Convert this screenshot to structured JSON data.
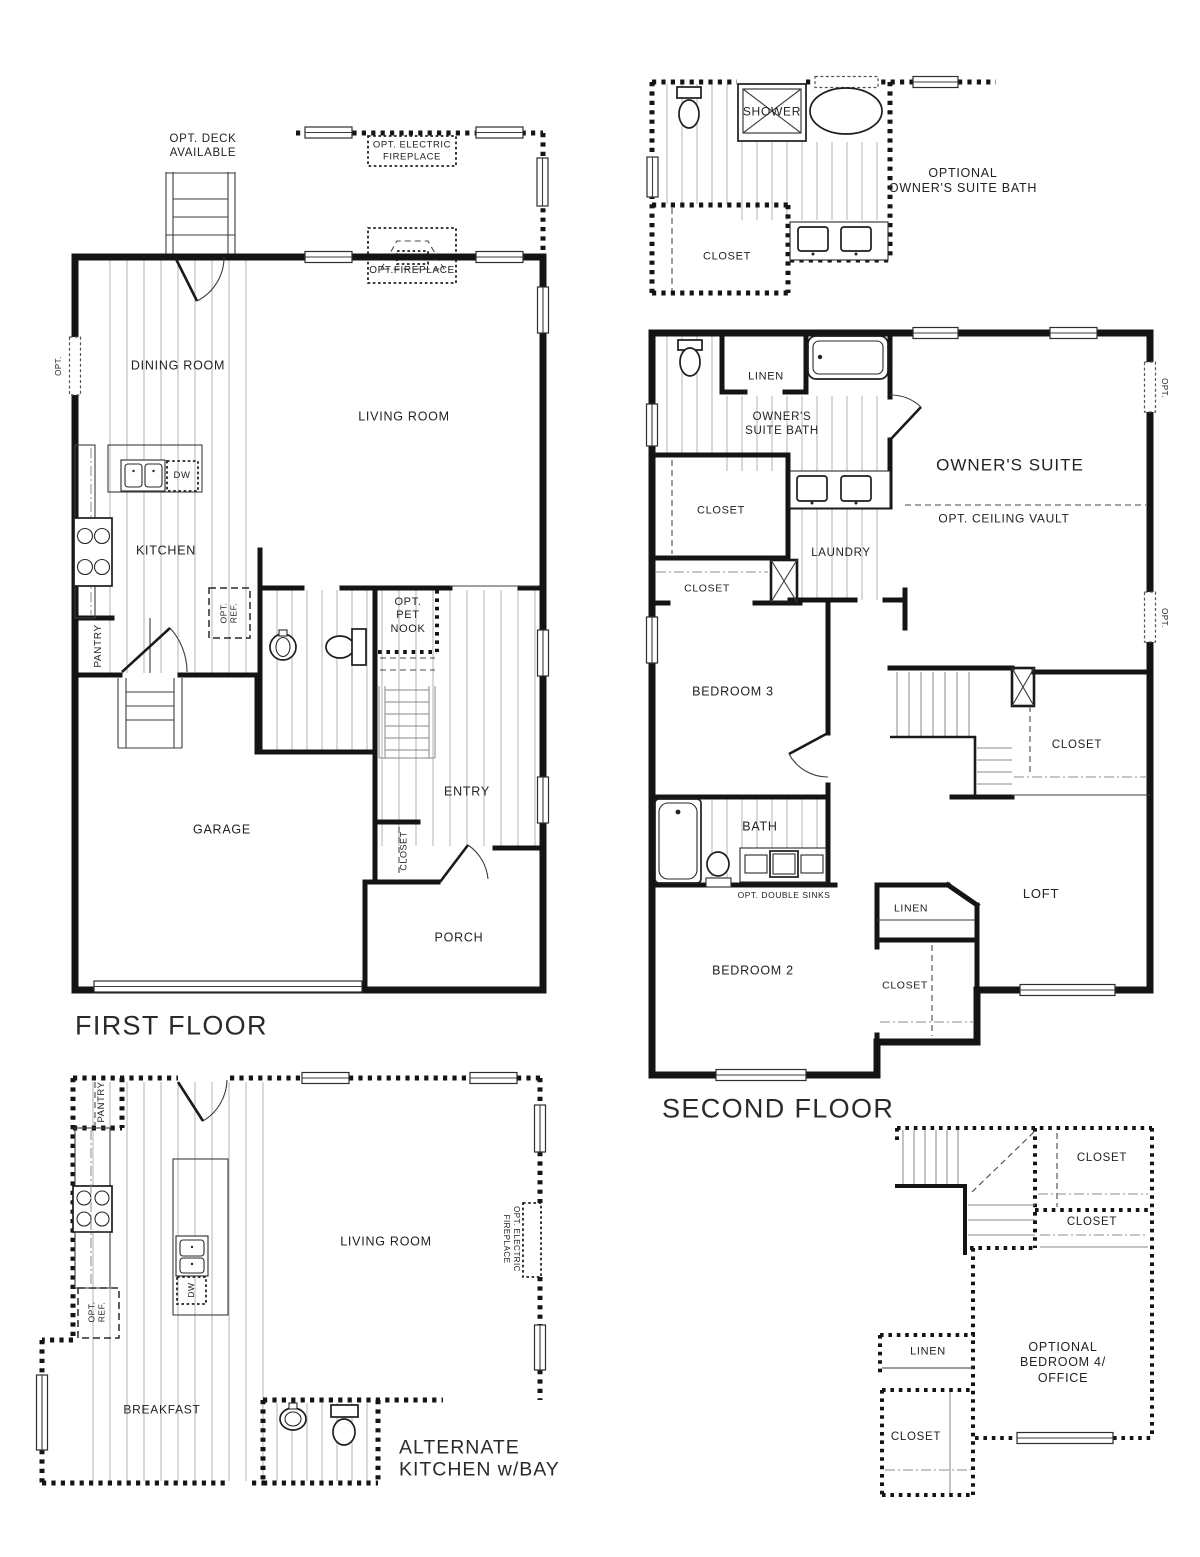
{
  "sheet": {
    "background": "#ffffff",
    "ink": "#141414"
  },
  "first_floor": {
    "title": "FIRST FLOOR",
    "rooms": {
      "dining_room": "DINING ROOM",
      "living_room": "LIVING ROOM",
      "kitchen": "KITCHEN",
      "entry": "ENTRY",
      "garage": "GARAGE",
      "porch": "PORCH",
      "pantry": "PANTRY",
      "closet": "CLOSET"
    },
    "notes": {
      "opt_deck": "OPT. DECK\nAVAILABLE",
      "opt_electric_fireplace": "OPT. ELECTRIC\nFIREPLACE",
      "opt_fireplace": "OPT.FIREPLACE",
      "opt_pet_nook": "OPT.\nPET\nNOOK",
      "opt_ref": "OPT.\nREF.",
      "dw": "DW",
      "opt_window": "OPT."
    }
  },
  "optional_owners_suite_bath": {
    "title": "OPTIONAL\nOWNER'S SUITE BATH",
    "rooms": {
      "shower": "SHOWER",
      "closet": "CLOSET"
    }
  },
  "second_floor": {
    "title": "SECOND FLOOR",
    "rooms": {
      "owners_suite": "OWNER'S SUITE",
      "owners_suite_bath": "OWNER'S\nSUITE BATH",
      "linen_bath": "LINEN",
      "closet_owners": "CLOSET",
      "closet_hall": "CLOSET",
      "laundry": "LAUNDRY",
      "bedroom3": "BEDROOM 3",
      "closet_stairs": "CLOSET",
      "bath": "BATH",
      "linen_hall": "LINEN",
      "bedroom2": "BEDROOM 2",
      "closet_bedroom2": "CLOSET",
      "loft": "LOFT"
    },
    "notes": {
      "opt_ceiling_vault": "OPT. CEILING VAULT",
      "opt_double_sinks": "OPT. DOUBLE SINKS",
      "opt_window_top": "OPT.",
      "opt_window_bottom": "OPT."
    }
  },
  "alternate_kitchen": {
    "title": "ALTERNATE\nKITCHEN w/BAY",
    "rooms": {
      "living_room": "LIVING ROOM",
      "breakfast": "BREAKFAST",
      "pantry": "PANTRY"
    },
    "notes": {
      "opt_ref": "OPT.\nREF.",
      "dw": "DW",
      "opt_electric_fireplace": "OPT. ELECTRIC\nFIREPLACE"
    }
  },
  "optional_bedroom4": {
    "title": "OPTIONAL\nBEDROOM 4/\nOFFICE",
    "rooms": {
      "closet_upper": "CLOSET",
      "closet_mid": "CLOSET",
      "linen": "LINEN",
      "closet_lower": "CLOSET"
    }
  }
}
